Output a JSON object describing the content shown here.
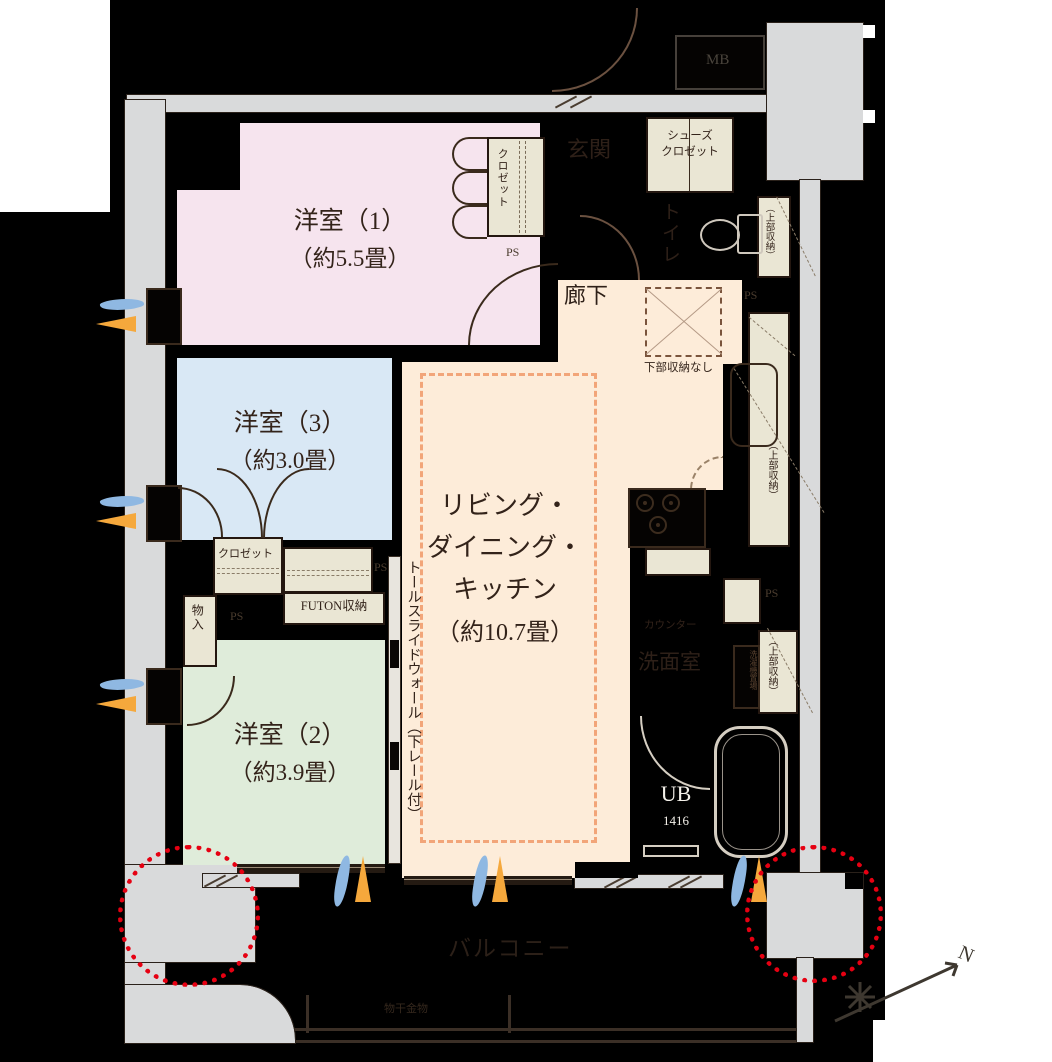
{
  "plan": {
    "rooms": {
      "y1": {
        "name": "洋室（1）",
        "size": "（約5.5畳）"
      },
      "y3": {
        "name": "洋室（3）",
        "size": "（約3.0畳）"
      },
      "y2": {
        "name": "洋室（2）",
        "size": "（約3.9畳）"
      },
      "ldk": {
        "line1": "リビング・",
        "line2": "ダイニング・",
        "line3": "キッチン",
        "size": "（約10.7畳）"
      }
    },
    "labels": {
      "genkan": "玄関",
      "rouka": "廊下",
      "toilet": "トイレ",
      "shoes1": "シューズ",
      "shoes2": "クロゼット",
      "closet": "クロゼット",
      "futon": "FUTON収納",
      "monoire": "物入",
      "senmen": "洗面室",
      "washer": "洗濯機置場",
      "counter": "カウンター",
      "ub": "UB",
      "ub_size": "1416",
      "balcony": "バルコニー",
      "monohoshi": "物干金物",
      "mb": "MB",
      "ps": "PS",
      "upper_storage": "（上部収納）",
      "lower_none": "下部収納なし",
      "tall_wall": "トールスライドウォール（下レール付）",
      "compass_n": "N"
    },
    "colors": {
      "room_pink": "#f6e4ee",
      "room_blue": "#d9e8f5",
      "room_green": "#dfecda",
      "room_peach": "#fdecd9",
      "cabinet_beige": "#eae6d4",
      "structure_gray": "#d9dadb",
      "wall_black": "#000000",
      "ldk_dash_orange": "#f2a579",
      "highlight_red": "#e60012",
      "vent_blue": "#8fb8e2",
      "vent_orange": "#f5a83c"
    }
  }
}
